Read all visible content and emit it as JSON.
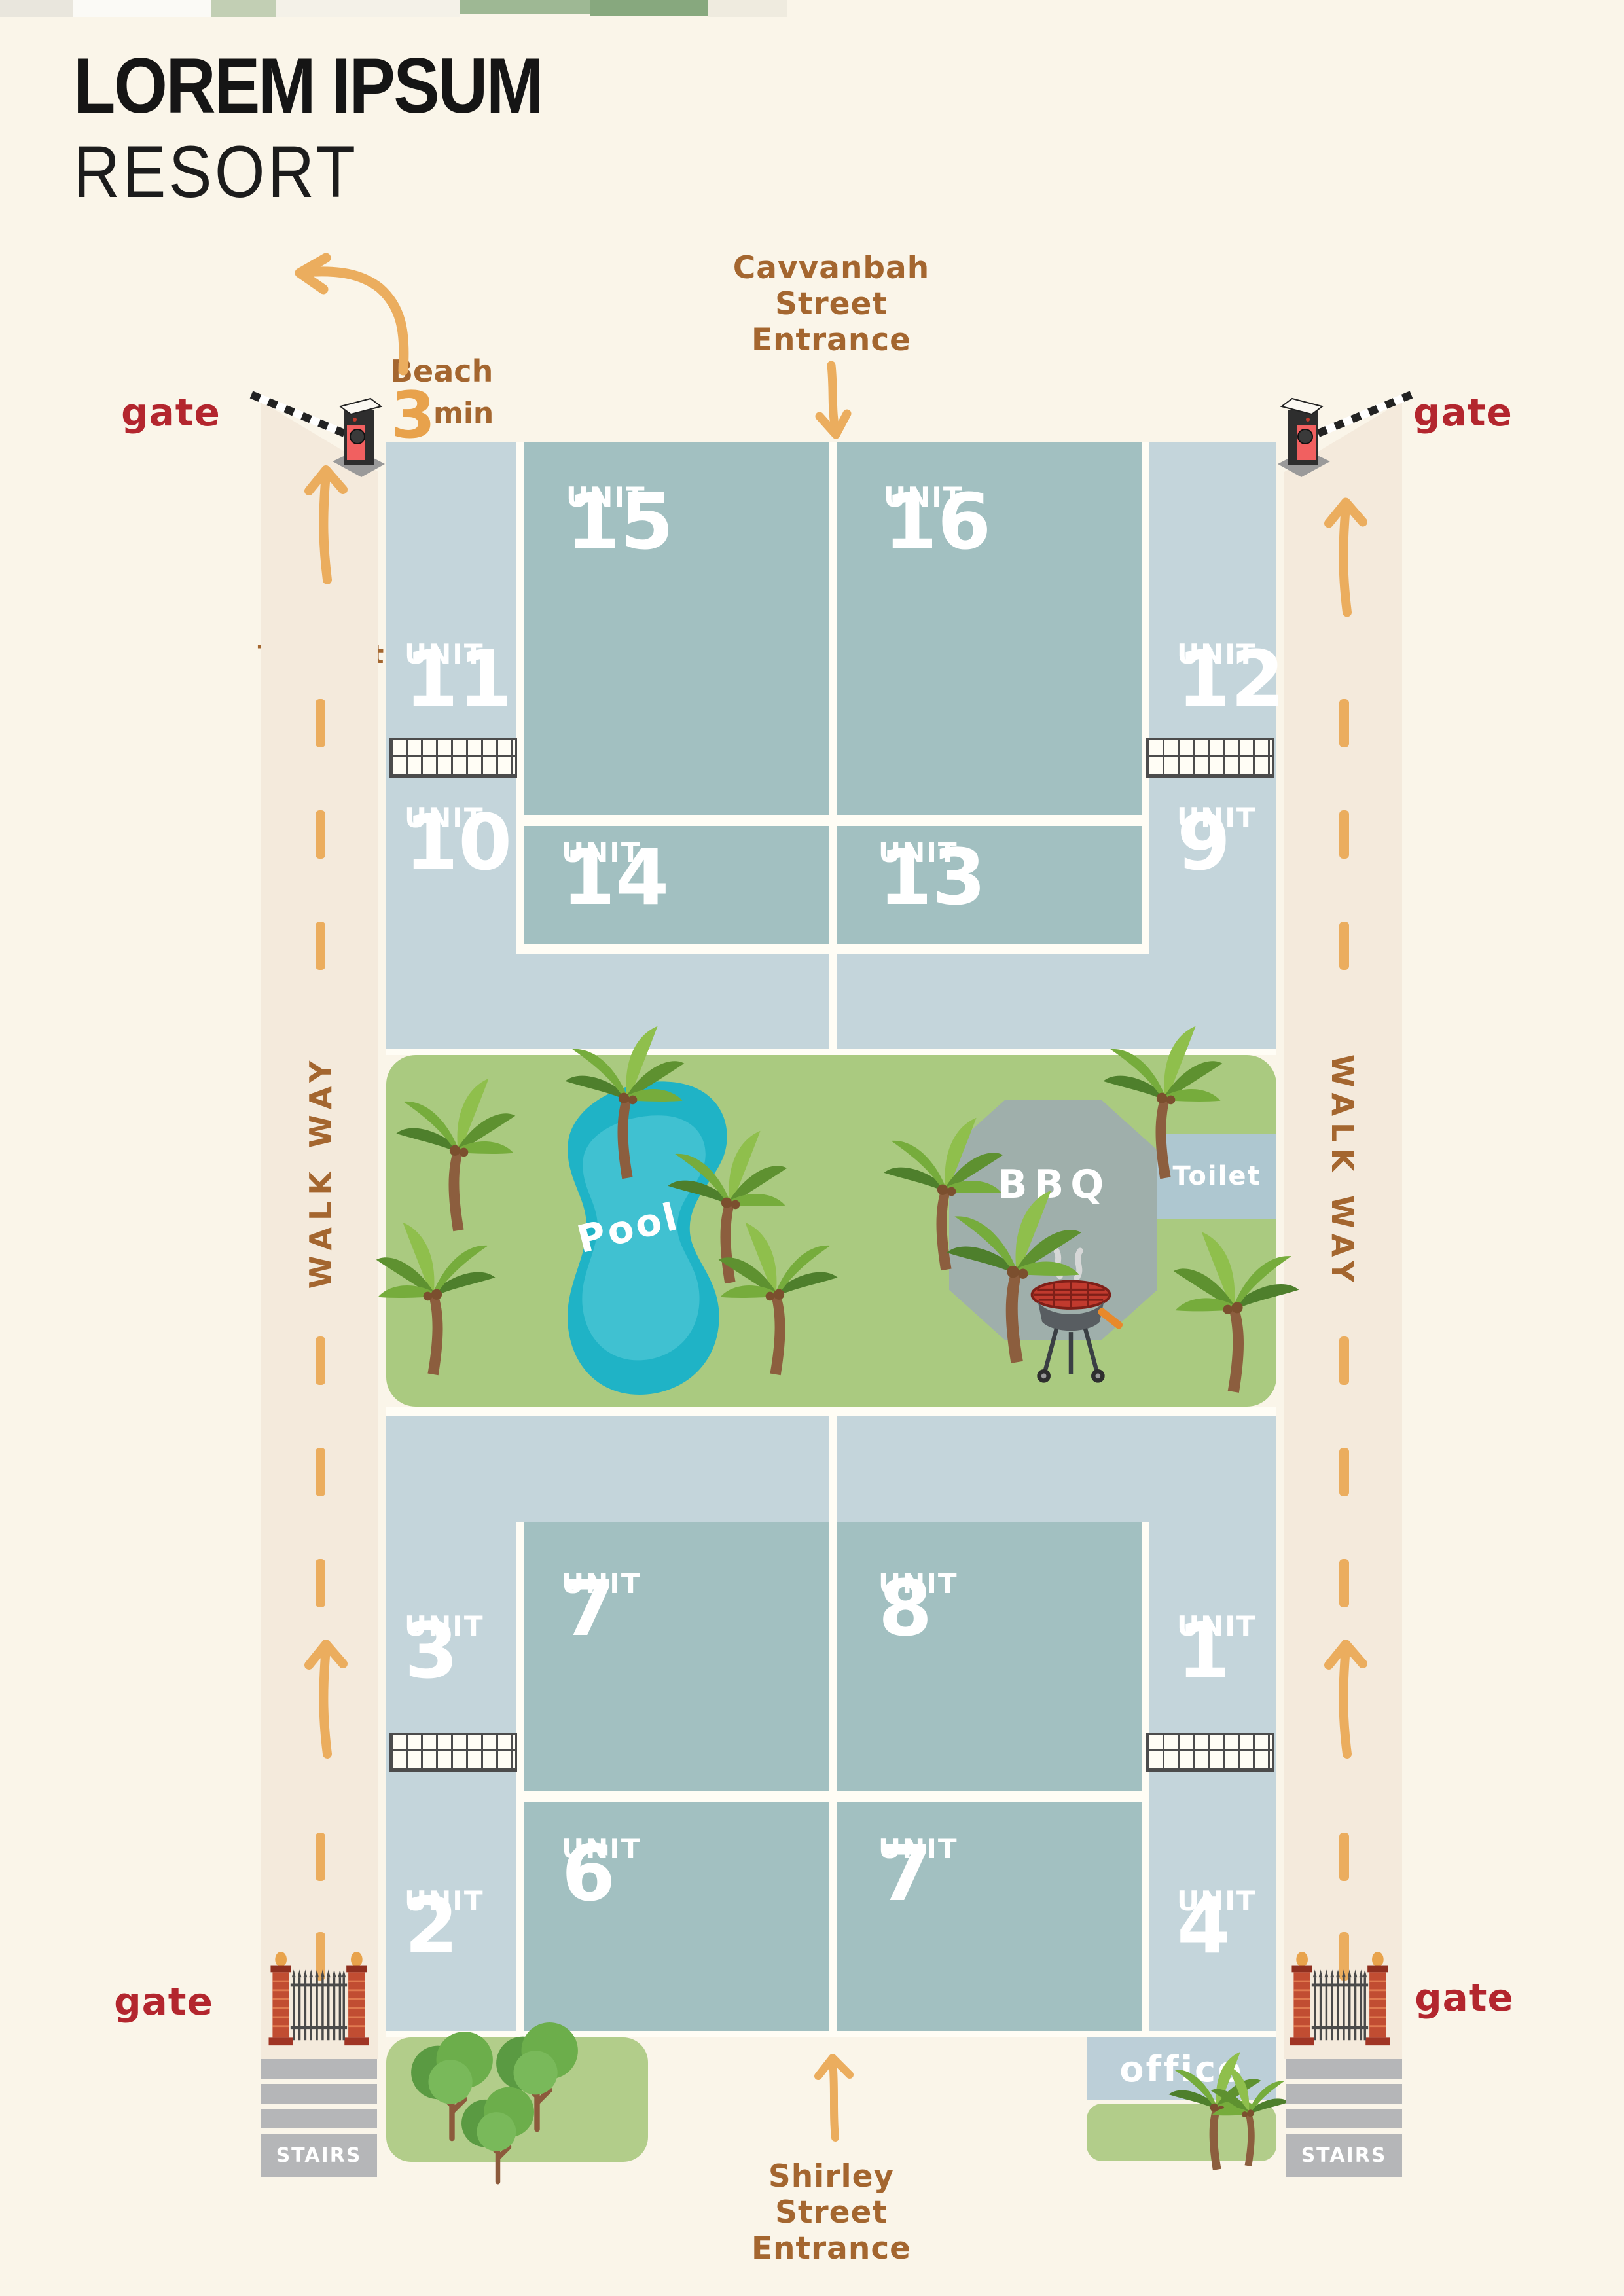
{
  "title": {
    "line1": "LOREM IPSUM",
    "line2": "RESORT"
  },
  "top_entrance": {
    "line1": "Cavvanbah",
    "line2": "Street",
    "line3": "Entrance"
  },
  "bottom_entrance": {
    "line1": "Shirley",
    "line2": "Street",
    "line3": "Entrance"
  },
  "gates": {
    "top_left": "gate",
    "top_right": "gate",
    "bottom_left": "gate",
    "bottom_right": "gate"
  },
  "beach": {
    "label": "Beach",
    "minutes": "3",
    "unit": "min",
    "access": {
      "line1": "Beach",
      "line2": "access",
      "line3": "Turn Left"
    }
  },
  "walkways": {
    "left": "WALK WAY",
    "right": "WALK WAY"
  },
  "unit_word": "UNIT",
  "units": {
    "u15": "15",
    "u16": "16",
    "u11": "11",
    "u12": "12",
    "u14": "14",
    "u13": "13",
    "u10": "10",
    "u9": "9",
    "u7a": "7",
    "u8": "8",
    "u3": "3",
    "u1": "1",
    "u6": "6",
    "u7b": "7",
    "u2": "2",
    "u4": "4"
  },
  "amenities": {
    "pool": "Pool",
    "bbq": "BBQ",
    "toilet": "Toilet",
    "office": "office",
    "stairs_left": "STAIRS",
    "stairs_right": "STAIRS"
  },
  "colors": {
    "background": "#FAF5E9",
    "walkway": "#F4EADC",
    "unit_light": "#C4D5DB",
    "unit_dark": "#A2C0C1",
    "lawn": "#AACA80",
    "pool": "#1FB3C6",
    "bbq_area": "#9FAFAB",
    "toilet_block": "#AEC7D0",
    "office_block": "#BCCFD8",
    "stairs": "#B5B6B8",
    "label_brown": "#A4662F",
    "label_red": "#B3262E",
    "arrow_orange": "#EBAD5E",
    "road_white": "#FFFDF5"
  }
}
